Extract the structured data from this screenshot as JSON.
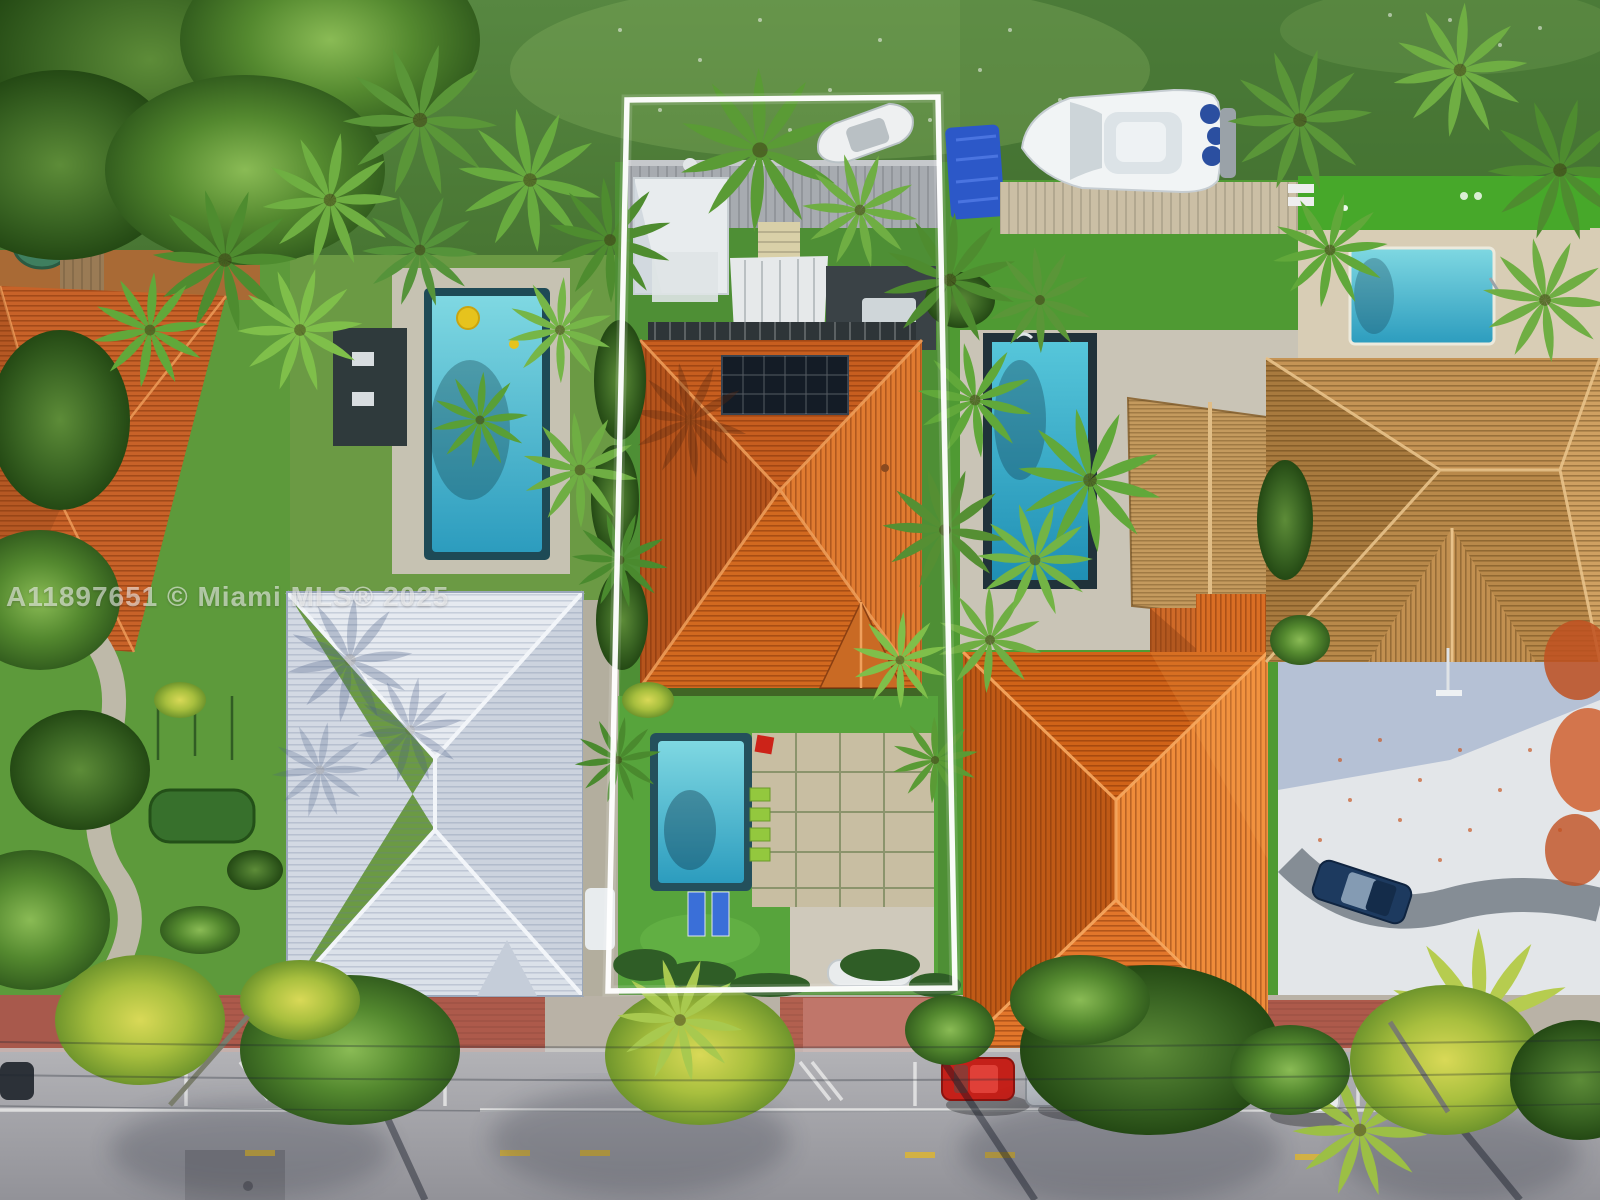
{
  "image": {
    "kind": "aerial-drone-photo-real-estate",
    "watermark_text": "A11897651 © Miami MLS® 2025"
  },
  "palette": {
    "canal_water_green": "#4f7f3a",
    "lawn_green": "#5d9a3b",
    "artificial_turf_green": "#4fae2e",
    "subject_roof_orange": "#e0762b",
    "right_roof_orange": "#e07428",
    "left_roof_orange": "#c86228",
    "gray_roof": "#dde2ea",
    "brown_tile_roof": "#bd8f52",
    "thatch_tan": "#c49a5e",
    "pool_teal": "#35aac4",
    "street_asphalt": "#a2a3a8",
    "sidewalk_brick_red": "#ad5a4b",
    "highlight_outline": "#ffffff"
  }
}
